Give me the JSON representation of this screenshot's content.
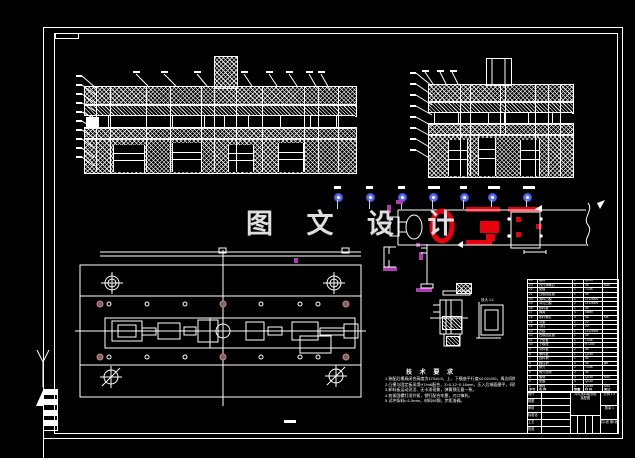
{
  "colors": {
    "line": "#ffffff",
    "red": "#e8000d",
    "blue": "#3c55e6",
    "magenta": "#b13ab3",
    "brown": "#8a5c5c",
    "watermark": "#dedede"
  },
  "watermark": {
    "text": "图 文 设 计"
  },
  "balloons": {
    "labels": [
      "1",
      "2",
      "3",
      "4",
      "5",
      "6",
      "7"
    ]
  },
  "detail": {
    "scale_label": "放大 1:1"
  },
  "notes": {
    "title": "技 术 要 求",
    "lines": [
      "1.装配后模具闭合高度为170±0.5，上、下模座平行度≤0.02/100，周边间隙均匀。",
      "2.凸模与固定板采用H7/m6配合，Z=0.12~0.16mm，压入后端面磨平，间隙≤0.02。",
      "3.卸料板运动灵活、无卡滞现象，弹簧预压量一致。",
      "4.各紧固螺钉须拧紧，销钉配合牢靠，刃口锋利。",
      "5.试冲条料t=1.5mm，材料08钢，步距准确。"
    ]
  },
  "parts_list": {
    "header": {
      "no": "序号",
      "name": "名 称",
      "qty": "数量",
      "mat": "材 料",
      "note": "备注"
    },
    "rows": [
      {
        "no": "1",
        "name": "螺栓",
        "qty": "4",
        "mat": "Q235",
        "note": "M10"
      },
      {
        "no": "2",
        "name": "垫圈",
        "qty": "4",
        "mat": "Q235",
        "note": ""
      },
      {
        "no": "3",
        "name": "螺母",
        "qty": "4",
        "mat": "Q235",
        "note": "M10"
      },
      {
        "no": "4",
        "name": "侧刃挡块",
        "qty": "2",
        "mat": "45",
        "note": ""
      },
      {
        "no": "5",
        "name": "侧刃",
        "qty": "2",
        "mat": "T10A",
        "note": ""
      },
      {
        "no": "6",
        "name": "圆柱销",
        "qty": "4",
        "mat": "35",
        "note": "φ8"
      },
      {
        "no": "7",
        "name": "挡料销",
        "qty": "1",
        "mat": "45",
        "note": ""
      },
      {
        "no": "8",
        "name": "承料板",
        "qty": "1",
        "mat": "Q235",
        "note": ""
      },
      {
        "no": "9",
        "name": "导料板",
        "qty": "2",
        "mat": "45",
        "note": ""
      },
      {
        "no": "10",
        "name": "下模座",
        "qty": "1",
        "mat": "HT200",
        "note": ""
      },
      {
        "no": "11",
        "name": "下垫板",
        "qty": "1",
        "mat": "T10A",
        "note": ""
      },
      {
        "no": "12",
        "name": "凹模固定板",
        "qty": "1",
        "mat": "45",
        "note": ""
      },
      {
        "no": "13",
        "name": "凹模",
        "qty": "1",
        "mat": "Cr12MoV",
        "note": ""
      },
      {
        "no": "14",
        "name": "导柱",
        "qty": "2",
        "mat": "20",
        "note": ""
      },
      {
        "no": "15",
        "name": "导套",
        "qty": "2",
        "mat": "20",
        "note": ""
      },
      {
        "no": "16",
        "name": "卸料螺钉",
        "qty": "4",
        "mat": "45",
        "note": "M8"
      },
      {
        "no": "17",
        "name": "弹簧",
        "qty": "4",
        "mat": "65Mn",
        "note": ""
      },
      {
        "no": "18",
        "name": "卸料板",
        "qty": "1",
        "mat": "45",
        "note": ""
      },
      {
        "no": "19",
        "name": "冲孔凸模",
        "qty": "2",
        "mat": "Cr12MoV",
        "note": ""
      },
      {
        "no": "20",
        "name": "落料凸模",
        "qty": "1",
        "mat": "Cr12MoV",
        "note": ""
      },
      {
        "no": "21",
        "name": "凸模固定板",
        "qty": "1",
        "mat": "45",
        "note": ""
      },
      {
        "no": "22",
        "name": "垫板",
        "qty": "1",
        "mat": "T10A",
        "note": ""
      },
      {
        "no": "23",
        "name": "内六角螺钉",
        "qty": "4",
        "mat": "45",
        "note": "M10"
      },
      {
        "no": "24",
        "name": "模柄",
        "qty": "1",
        "mat": "Q235",
        "note": ""
      },
      {
        "no": "25",
        "name": "上模座",
        "qty": "1",
        "mat": "HT200",
        "note": ""
      }
    ]
  },
  "title_block": {
    "left_labels": [
      "设计",
      "制图",
      "审核",
      "标准化",
      "工艺",
      "批准"
    ],
    "name_line1": "冲孔落料级进模",
    "name_line2": "装配图",
    "scale_row": "比例 1:1",
    "qty_row": "数量 1",
    "sheet_row": "共1张 第1张"
  }
}
